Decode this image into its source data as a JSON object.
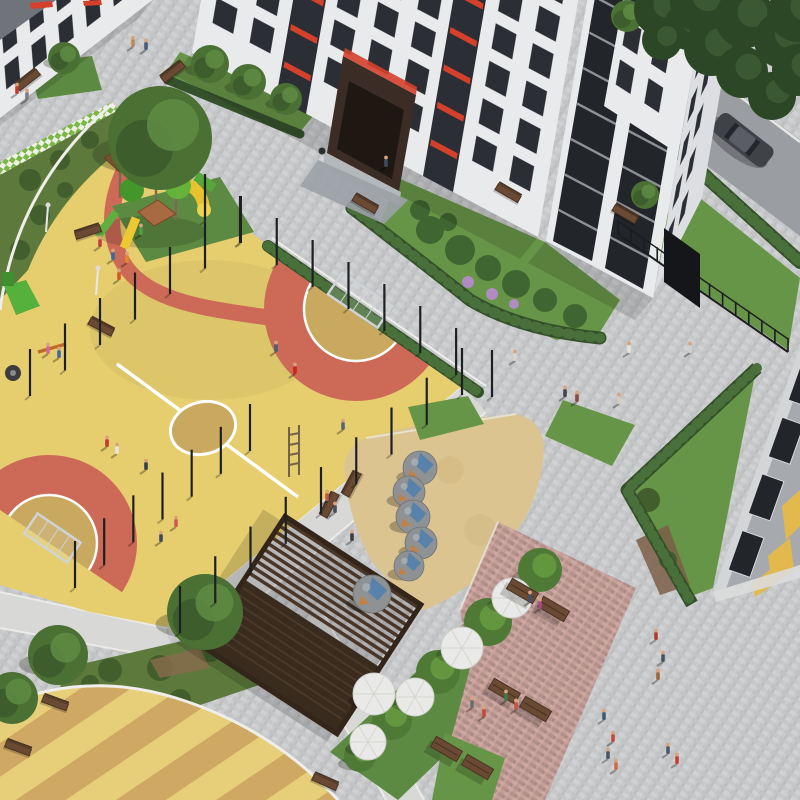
{
  "palette": {
    "plaza": "#c9cacc",
    "tileA": "#c2c3c5",
    "tileB": "#d0d1d3",
    "tileC": "#bcbec0",
    "pathLight": "#d8d8d7",
    "curb": "#efeeea",
    "yellow": "#e6ce6e",
    "redSurface": "#cd6a57",
    "fieldTan": "#c9a85f",
    "lineWhite": "#ffffff",
    "grass": "#679547",
    "grassDark": "#5d8a42",
    "hedge": "#35512b",
    "hedgeLight": "#49703a",
    "shrub": "#5d7a3c",
    "shrubDark": "#415e2c",
    "treeDark": "#2c4726",
    "treeLite": "#44663a",
    "canopy": "#4a7034",
    "canopyLite": "#5d8a42",
    "sand": "#dcc491",
    "sandShade": "#cbb179",
    "wallWhite": "#e9eaec",
    "wallShade": "#dcdee1",
    "wallGray": "#a6aaae",
    "glass": "#2b2f35",
    "glassDark": "#22252a",
    "mullion": "#f2f3f5",
    "redAccent": "#d5402b",
    "portal": "#3b2d26",
    "pergola": "#4a3627",
    "pergolaDark": "#33251a",
    "pinkPlaza": "#c49e99",
    "road": "#9a9da1",
    "car": "#3f4247",
    "domeGray": "#8f9295",
    "domeBlue": "#4f7fae",
    "domeOrange": "#c5803f",
    "stripeA": "#cfa964",
    "stripeB": "#e6cf78",
    "woodBench": "#6b4a33",
    "benchDark": "#4a3424",
    "fence": "#1b1d1f",
    "umbrella": "#e9e9e7",
    "lilac": "#b08cc0",
    "skin": "#d8a47e",
    "yellowPanel": "#e3b94e",
    "checkGreen": "#7ab648",
    "checkWhite": "#eef2e4"
  },
  "objects": {
    "people": [
      [
        133,
        46,
        "#b98a5a"
      ],
      [
        146,
        49,
        "#4a5a78"
      ],
      [
        17,
        93,
        "#c03a2e"
      ],
      [
        27,
        99,
        "#7a7d82"
      ],
      [
        515,
        360,
        "#d8d5cf"
      ],
      [
        565,
        396,
        "#3e4550"
      ],
      [
        577,
        401,
        "#8a4a42"
      ],
      [
        619,
        403,
        "#d6cdb8"
      ],
      [
        629,
        352,
        "#e4e2dd"
      ],
      [
        690,
        352,
        "#cfd0d2"
      ],
      [
        386,
        166,
        "#3c4a62"
      ],
      [
        100,
        246,
        "#c04038"
      ],
      [
        113,
        259,
        "#3a6aa0"
      ],
      [
        127,
        262,
        "#e08830"
      ],
      [
        141,
        234,
        "#4aa046"
      ],
      [
        119,
        279,
        "#d05a28"
      ],
      [
        107,
        446,
        "#c23a32"
      ],
      [
        117,
        453,
        "#e8e6e0"
      ],
      [
        146,
        469,
        "#36404e"
      ],
      [
        276,
        351,
        "#4a5e74"
      ],
      [
        295,
        373,
        "#cc2420"
      ],
      [
        176,
        526,
        "#d05850"
      ],
      [
        161,
        541,
        "#3c4a60"
      ],
      [
        48,
        353,
        "#d06a9a"
      ],
      [
        59,
        357,
        "#4668a8"
      ],
      [
        327,
        500,
        "#c05848"
      ],
      [
        335,
        512,
        "#46505e"
      ],
      [
        343,
        429,
        "#5a6478"
      ],
      [
        352,
        540,
        "#3a3d42"
      ],
      [
        656,
        639,
        "#b03a32"
      ],
      [
        663,
        661,
        "#485464"
      ],
      [
        658,
        679,
        "#96683c"
      ],
      [
        604,
        719,
        "#3a5a74"
      ],
      [
        613,
        741,
        "#c24a3c"
      ],
      [
        530,
        601,
        "#46506a"
      ],
      [
        540,
        608,
        "#a84a8a"
      ],
      [
        506,
        700,
        "#3a7a46"
      ],
      [
        516,
        709,
        "#c25648"
      ],
      [
        608,
        758,
        "#4a5468"
      ],
      [
        616,
        769,
        "#cc6a4a"
      ],
      [
        472,
        707,
        "#6a6e74"
      ],
      [
        484,
        716,
        "#c04a3a"
      ],
      [
        668,
        753,
        "#505a6a"
      ],
      [
        677,
        763,
        "#c83e34"
      ]
    ],
    "fences": [
      {
        "a": [
          205,
          218
        ],
        "b": [
          492,
          394
        ],
        "n": 8
      },
      {
        "a": [
          462,
          392
        ],
        "b": [
          180,
          630
        ],
        "n": 8
      },
      {
        "a": [
          250,
          448
        ],
        "b": [
          75,
          585
        ],
        "n": 6
      },
      {
        "a": [
          240,
          240
        ],
        "b": [
          -40,
          444
        ],
        "n": 8
      }
    ],
    "domes": [
      [
        420,
        468,
        17
      ],
      [
        409,
        492,
        16
      ],
      [
        413,
        517,
        17
      ],
      [
        421,
        543,
        16
      ],
      [
        409,
        566,
        15
      ],
      [
        372,
        594,
        19
      ]
    ],
    "bigTrees": [
      [
        160,
        138,
        52
      ],
      [
        205,
        612,
        38
      ],
      [
        58,
        655,
        30
      ],
      [
        12,
        698,
        26
      ],
      [
        210,
        64,
        19
      ],
      [
        248,
        82,
        18
      ],
      [
        286,
        99,
        16
      ],
      [
        64,
        58,
        16
      ],
      [
        627,
        16,
        16
      ],
      [
        645,
        195,
        14
      ]
    ],
    "darkTrees": [
      [
        660,
        10,
        26
      ],
      [
        688,
        26,
        24
      ],
      [
        712,
        48,
        28
      ],
      [
        742,
        72,
        26
      ],
      [
        772,
        96,
        24
      ],
      [
        700,
        2,
        30
      ],
      [
        745,
        18,
        30
      ],
      [
        782,
        40,
        28
      ],
      [
        798,
        70,
        26
      ],
      [
        798,
        12,
        30
      ],
      [
        662,
        40,
        20
      ]
    ],
    "stripTrees": [
      [
        540,
        570,
        22
      ],
      [
        488,
        622,
        24
      ],
      [
        438,
        672,
        22
      ],
      [
        392,
        720,
        20
      ],
      [
        360,
        756,
        16
      ]
    ],
    "umbrellas": [
      [
        512,
        598,
        20
      ],
      [
        462,
        648,
        21
      ],
      [
        415,
        697,
        19
      ],
      [
        368,
        742,
        18
      ],
      [
        374,
        694,
        21
      ]
    ],
    "benches": [
      [
        88,
        232,
        -18
      ],
      [
        28,
        80,
        -38
      ],
      [
        173,
        72,
        -38
      ],
      [
        365,
        204,
        30
      ],
      [
        508,
        193,
        30
      ],
      [
        625,
        214,
        30
      ],
      [
        101,
        327,
        28
      ],
      [
        352,
        484,
        -62
      ],
      [
        330,
        505,
        -62
      ],
      [
        55,
        703,
        20
      ],
      [
        18,
        748,
        20
      ],
      [
        325,
        782,
        24
      ]
    ],
    "picnicSets": [
      [
        538,
        600,
        30
      ],
      [
        520,
        700,
        30
      ],
      [
        462,
        758,
        30
      ]
    ],
    "lamps": [
      [
        46,
        232
      ],
      [
        96,
        295
      ]
    ],
    "facades": {
      "main": {
        "o": [
          193,
          45
        ],
        "u": [
          0.883,
          0.469
        ],
        "v": [
          0.17,
          -0.985
        ],
        "c0": 16,
        "dc": 42,
        "nc": 9,
        "w": 24,
        "r0": 30,
        "dr": 38,
        "nr": 7,
        "h": 26,
        "skip": [
          2,
          6
        ]
      },
      "rightface": {
        "o": [
          655,
          291
        ],
        "u": [
          0.45,
          -0.89
        ],
        "v": [
          0.17,
          -0.985
        ],
        "c0": 10,
        "dc": 30,
        "nc": 2,
        "w": 16,
        "r0": 28,
        "dr": 44,
        "nr": 6,
        "h": 26,
        "skip": []
      },
      "sidewall": {
        "o": [
          606,
          96
        ],
        "u": [
          0.84,
          0.55
        ],
        "v": [
          0.17,
          -0.985
        ],
        "c0": 8,
        "dc": 34,
        "nc": 2,
        "w": 18,
        "r0": 16,
        "dr": 40,
        "nr": 3,
        "h": 26,
        "skip": []
      },
      "leftwing": {
        "o": [
          0,
          118
        ],
        "u": [
          0.79,
          -0.61
        ],
        "v": [
          -0.08,
          -0.997
        ],
        "c0": 10,
        "dc": 34,
        "nc": 5,
        "w": 18,
        "r0": 22,
        "dr": 36,
        "nr": 3,
        "h": 24,
        "skip": []
      }
    },
    "mainGlazeStrips": [
      98,
      264
    ],
    "towerGlaze": {
      "o": [
        547,
        233
      ],
      "u": [
        0.883,
        0.469
      ],
      "v": [
        0.17,
        -0.985
      ],
      "strips": [
        8,
        66
      ],
      "stripW": 44,
      "mullions": 9
    },
    "faceA": {
      "o": [
        713,
        592
      ],
      "e": [
        87,
        -246
      ],
      "n": [
        0.942,
        0.333
      ],
      "bands": [
        [
          0.1,
          0.26
        ],
        [
          0.33,
          0.49
        ],
        [
          0.56,
          0.72
        ],
        [
          0.79,
          0.95
        ]
      ],
      "d1": 7,
      "d2": 30
    }
  }
}
